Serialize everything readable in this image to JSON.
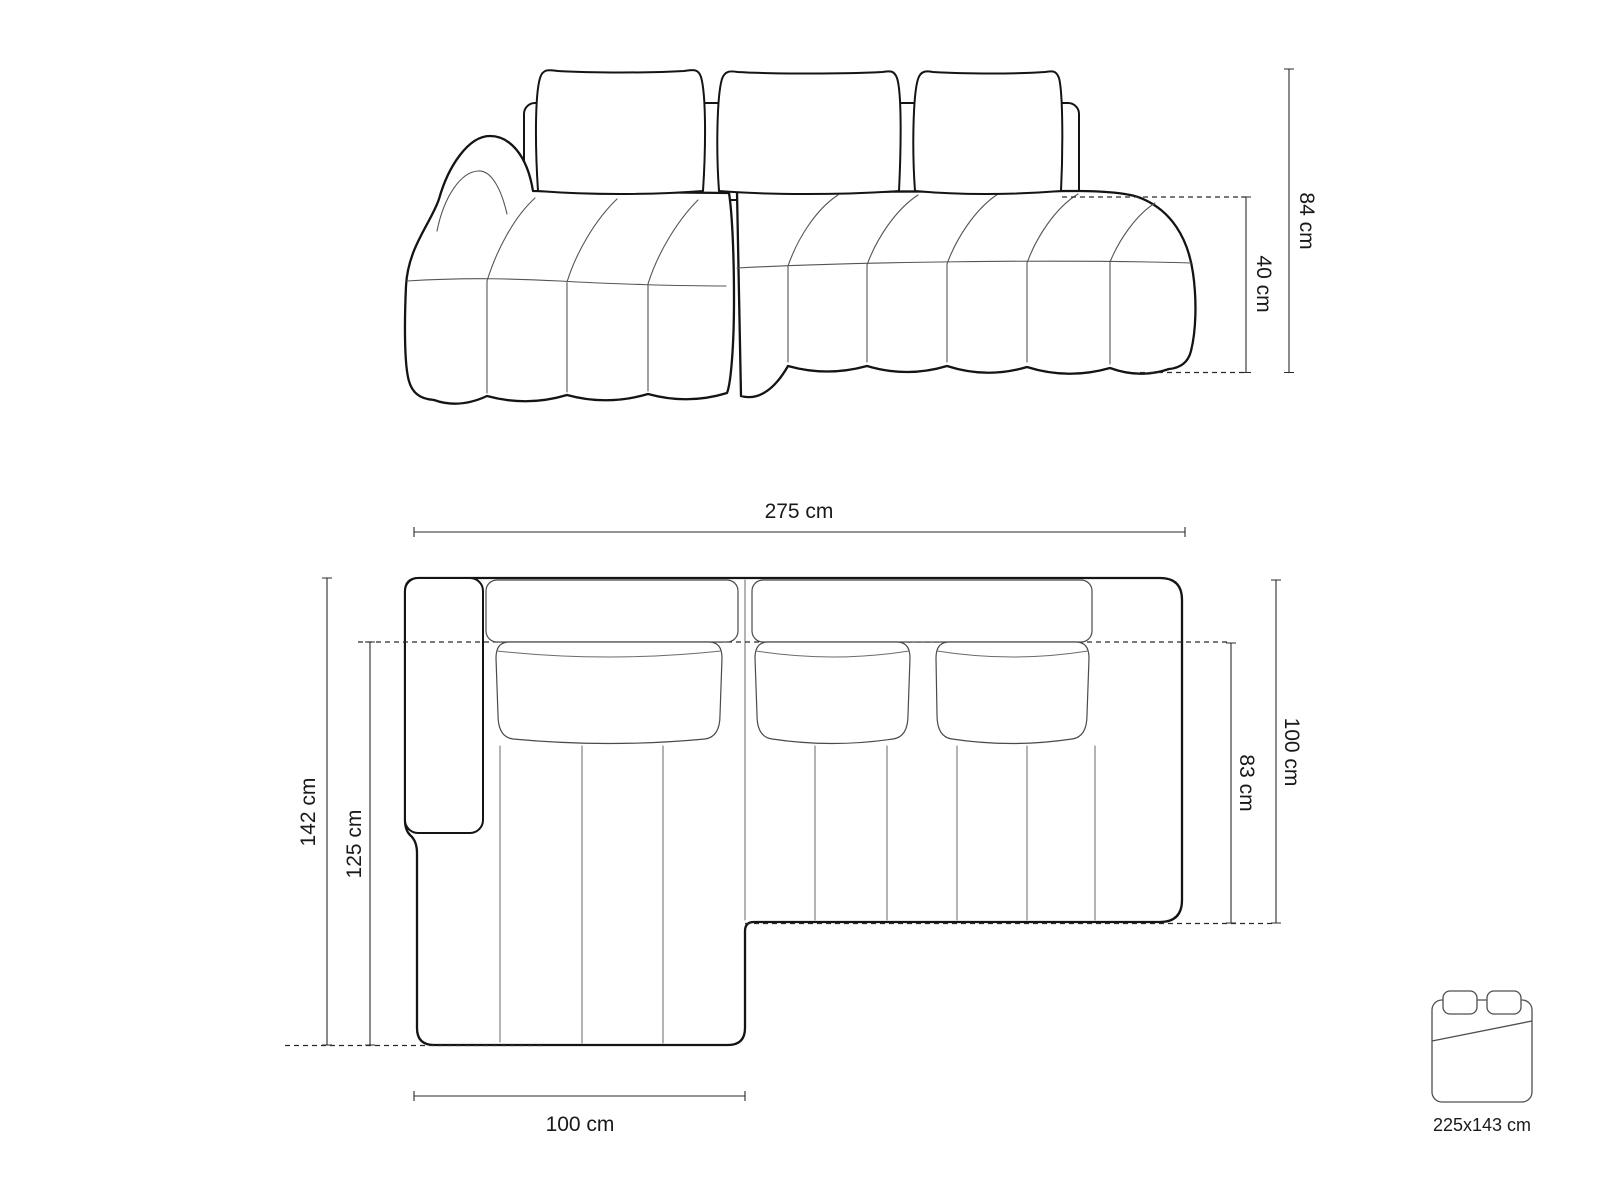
{
  "page": {
    "background": "#ffffff",
    "description": "Technical dimension drawing of a corner sofa with chaise: front elevation view, top plan view and sleeping-surface icon"
  },
  "colors": {
    "outline": "#141414",
    "thin_line": "#555555",
    "dimension_line": "#2b2b2b",
    "text": "#1a1a1a"
  },
  "front_view": {
    "name": "sofa-front-elevation",
    "dimensions": [
      {
        "id": "overall-height",
        "label": "84 cm",
        "orientation": "vertical-right"
      },
      {
        "id": "seat-height",
        "label": "40 cm",
        "orientation": "vertical-right"
      }
    ]
  },
  "top_view": {
    "name": "sofa-top-plan",
    "dimensions": [
      {
        "id": "overall-width",
        "label": "275 cm",
        "orientation": "horizontal-top"
      },
      {
        "id": "overall-depth",
        "label": "142 cm",
        "orientation": "vertical-left"
      },
      {
        "id": "chaise-inner-depth",
        "label": "125 cm",
        "orientation": "vertical-left"
      },
      {
        "id": "body-depth",
        "label": "100 cm",
        "orientation": "vertical-right"
      },
      {
        "id": "seat-depth",
        "label": "83 cm",
        "orientation": "vertical-right"
      },
      {
        "id": "chaise-width",
        "label": "100 cm",
        "orientation": "horizontal-bottom"
      }
    ]
  },
  "sleeping_function": {
    "icon": "bed-icon",
    "label": "225x143 cm"
  }
}
